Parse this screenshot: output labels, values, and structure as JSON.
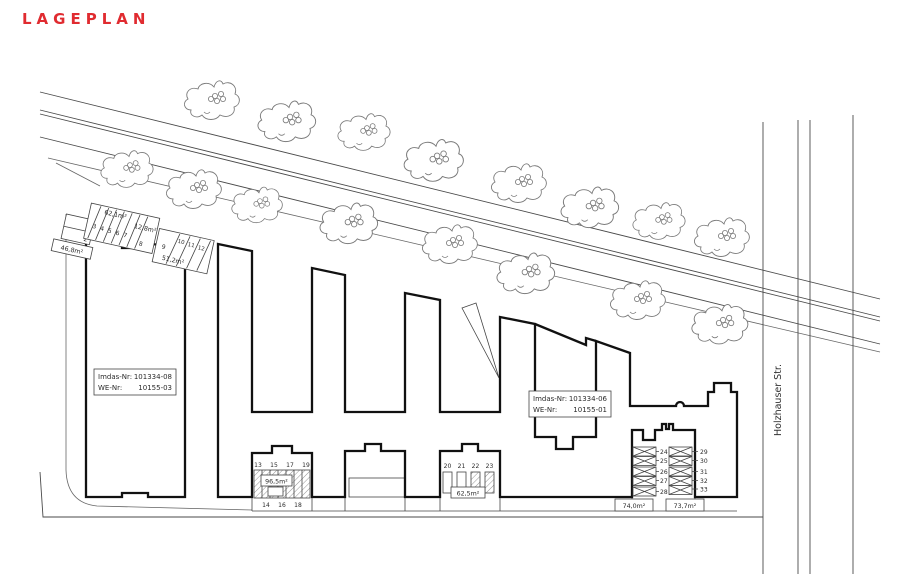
{
  "title": "LAGEPLAN",
  "street_label": "Holzhauser Str.",
  "info_boxes": [
    {
      "imdas_label": "Imdas-Nr:",
      "imdas_value": "101334-08",
      "we_label": "WE-Nr:",
      "we_value": "10155-03"
    },
    {
      "imdas_label": "Imdas-Nr:",
      "imdas_value": "101334-06",
      "we_label": "WE-Nr:",
      "we_value": "10155-01"
    }
  ],
  "accent_color": "#e02b30",
  "parking": {
    "nw12": {
      "stalls": [
        "1",
        "2"
      ],
      "area": "46,8m²"
    },
    "nw38": {
      "stalls": [
        "3",
        "4",
        "5",
        "6",
        "7"
      ],
      "stall8": "8",
      "area": "62,1m²",
      "area_right": "12,8m²"
    },
    "nw912": {
      "stall9": "9",
      "stalls": [
        "10",
        "11",
        "12"
      ],
      "area": "51,2m²"
    },
    "s1319": {
      "top": [
        "13",
        "15",
        "17",
        "19"
      ],
      "bottom": [
        "14",
        "16",
        "18"
      ],
      "area": "96,5m²"
    },
    "s2023": {
      "stalls": [
        "20",
        "21",
        "22",
        "23"
      ],
      "area": "62,5m²"
    },
    "e2428": {
      "stalls": [
        "24",
        "25",
        "26",
        "27",
        "28"
      ],
      "area": "74,0m²"
    },
    "e2933": {
      "stalls": [
        "29",
        "30",
        "31",
        "32",
        "33"
      ],
      "area": "73,7m²"
    }
  }
}
